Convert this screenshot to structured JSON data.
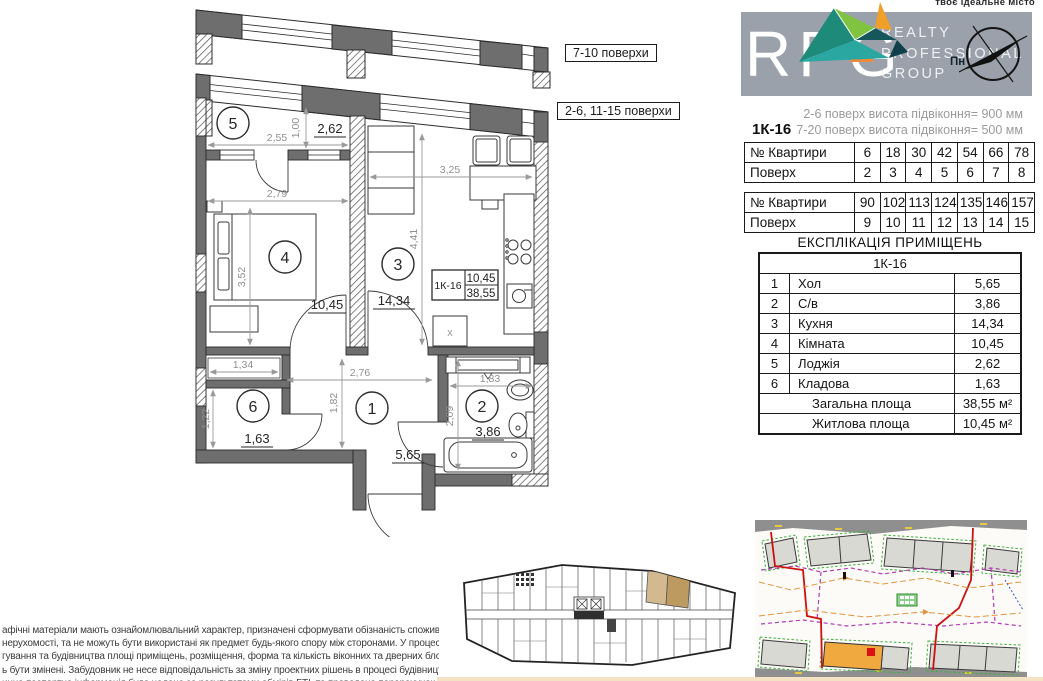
{
  "header": {
    "tagline": "твоє ідеальне місто",
    "logo_abbr": "RPG",
    "logo_lines": [
      "REALTY",
      "PROFESSIONAL",
      "GROUP"
    ],
    "compass_label": "Пн"
  },
  "notes": {
    "sill_1": "2-6 поверх висота підвіконня= 900 мм",
    "sill_2": "7-20 поверх висота підвіконня= 500 мм",
    "unit_code": "1К-16"
  },
  "floor_tables": [
    {
      "rows": [
        {
          "label": "№ Квартири",
          "values": [
            "6",
            "18",
            "30",
            "42",
            "54",
            "66",
            "78"
          ]
        },
        {
          "label": "Поверх",
          "values": [
            "2",
            "3",
            "4",
            "5",
            "6",
            "7",
            "8"
          ]
        }
      ]
    },
    {
      "rows": [
        {
          "label": "№ Квартири",
          "values": [
            "90",
            "102",
            "113",
            "124",
            "135",
            "146",
            "157"
          ]
        },
        {
          "label": "Поверх",
          "values": [
            "9",
            "10",
            "11",
            "12",
            "13",
            "14",
            "15"
          ]
        }
      ]
    }
  ],
  "explication": {
    "title": "ЕКСПЛІКАЦІЯ ПРИМІЩЕНЬ",
    "unit": "1К-16",
    "rows": [
      {
        "num": "1",
        "name": "Хол",
        "area": "5,65"
      },
      {
        "num": "2",
        "name": "С/в",
        "area": "3,86"
      },
      {
        "num": "3",
        "name": "Кухня",
        "area": "14,34"
      },
      {
        "num": "4",
        "name": "Кімната",
        "area": "10,45"
      },
      {
        "num": "5",
        "name": "Лоджія",
        "area": "2,62"
      },
      {
        "num": "6",
        "name": "Кладова",
        "area": "1,63"
      }
    ],
    "totals": [
      {
        "name": "Загальна площа",
        "area": "38,55 м²"
      },
      {
        "name": "Житлова площа",
        "area": "10,45 м²"
      }
    ]
  },
  "plan": {
    "floor_label_top": "7-10 поверхи",
    "floor_label_main": "2-6, 11-15 поверхи",
    "unit_tag": {
      "code": "1К-16",
      "living": "10,45",
      "total": "38,55"
    },
    "rooms": [
      {
        "num": "1",
        "area": "5,65"
      },
      {
        "num": "2",
        "area": "3,86"
      },
      {
        "num": "3",
        "area": "14,34"
      },
      {
        "num": "4",
        "area": "10,45"
      },
      {
        "num": "5",
        "area": "2,62"
      },
      {
        "num": "6",
        "area": "1,63"
      }
    ],
    "dims": {
      "balcony_w": "2,55",
      "balcony_d": "1,00",
      "room_w": "2,79",
      "room_h": "3,52",
      "kitchen_w": "3,25",
      "kitchen_h": "4,41",
      "closet_w": "1,34",
      "closet_h": "1,22",
      "hall_w": "2,76",
      "hall_h": "1,82",
      "bath_w": "1,83",
      "bath_h": "2,09"
    },
    "wash_mark": "x"
  },
  "disclaimer": {
    "lines": [
      "афічні матеріали мають ознайомлювальний характер, призначені сформувати обізнаність споживачів",
      "нерухомості, та не можуть бути використані як предмет будь-якого спору між сторонами. У процесі",
      "гування та будівництва площі приміщень, розміщення, форма та кількість віконних та дверних блоків",
      "ь бути змінені. Забудовник не несе відповідальність за зміну проектних рішень в процесі будівництва.",
      "инна паспортна інформація буде надана за результатами обмірів БТІ, та проведено перерахунок"
    ]
  },
  "colors": {
    "banner": "#9aa1ab",
    "accent_orange": "#f08a3c",
    "map_building_highlight": "#efa93f",
    "map_marker_red": "#dd1111",
    "overview_highlight_tan": "#c09a60"
  }
}
